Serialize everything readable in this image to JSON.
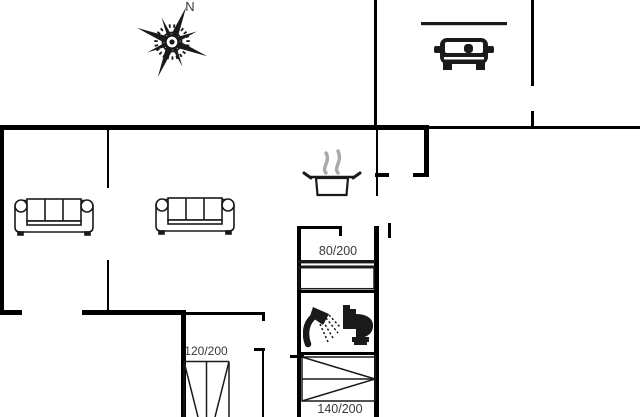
{
  "meta": {
    "type": "holiday-house-floor-plan"
  },
  "palette": {
    "background": "#ffffff",
    "wall": "#000000",
    "line": "#1a1a1a",
    "text": "#3a3a3a",
    "steam": "#a9a9a9"
  },
  "compass": {
    "north_label": "N"
  },
  "bed_labels": {
    "bed_80": "80/200",
    "bed_120": "120/200",
    "bed_140": "140/200"
  },
  "icons": {
    "compass": "compass-rose-icon",
    "carport": "car-icon",
    "sofa_left": "sofa-icon",
    "sofa_right": "sofa-icon",
    "kitchen": "cooking-pot-steam-icon",
    "shower": "shower-icon",
    "toilet": "toilet-icon"
  }
}
